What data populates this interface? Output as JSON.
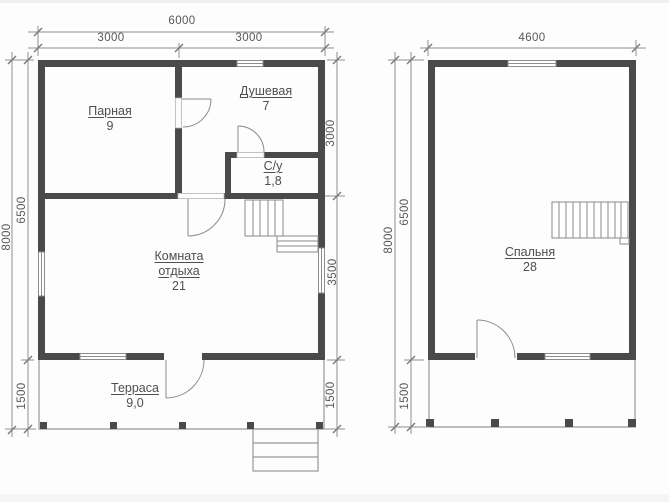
{
  "colors": {
    "wall": "#4a4a4a",
    "thin_line": "#8c8c8c",
    "text": "#555555",
    "background": "#fdfdfd"
  },
  "floor1": {
    "rooms": {
      "parnaya": {
        "name": "Парная",
        "area": "9"
      },
      "dushevaya": {
        "name": "Душевая",
        "area": "7"
      },
      "su": {
        "name": "С/у",
        "area": "1,8"
      },
      "komnata": {
        "name": "Комната отдыха",
        "area": "21"
      },
      "terrasa": {
        "name": "Терраса",
        "area": "9,0"
      }
    },
    "dims": {
      "width_total": "6000",
      "width_left": "3000",
      "width_right": "3000",
      "height_total": "8000",
      "height_main": "6500",
      "height_terrace": "1500",
      "right_top": "3000",
      "right_mid": "3500",
      "right_bottom": "1500"
    }
  },
  "floor2": {
    "rooms": {
      "spalnya": {
        "name": "Спальня",
        "area": "28"
      }
    },
    "dims": {
      "width_total": "4600",
      "height_total": "8000",
      "height_main": "6500",
      "height_terrace": "1500"
    }
  }
}
